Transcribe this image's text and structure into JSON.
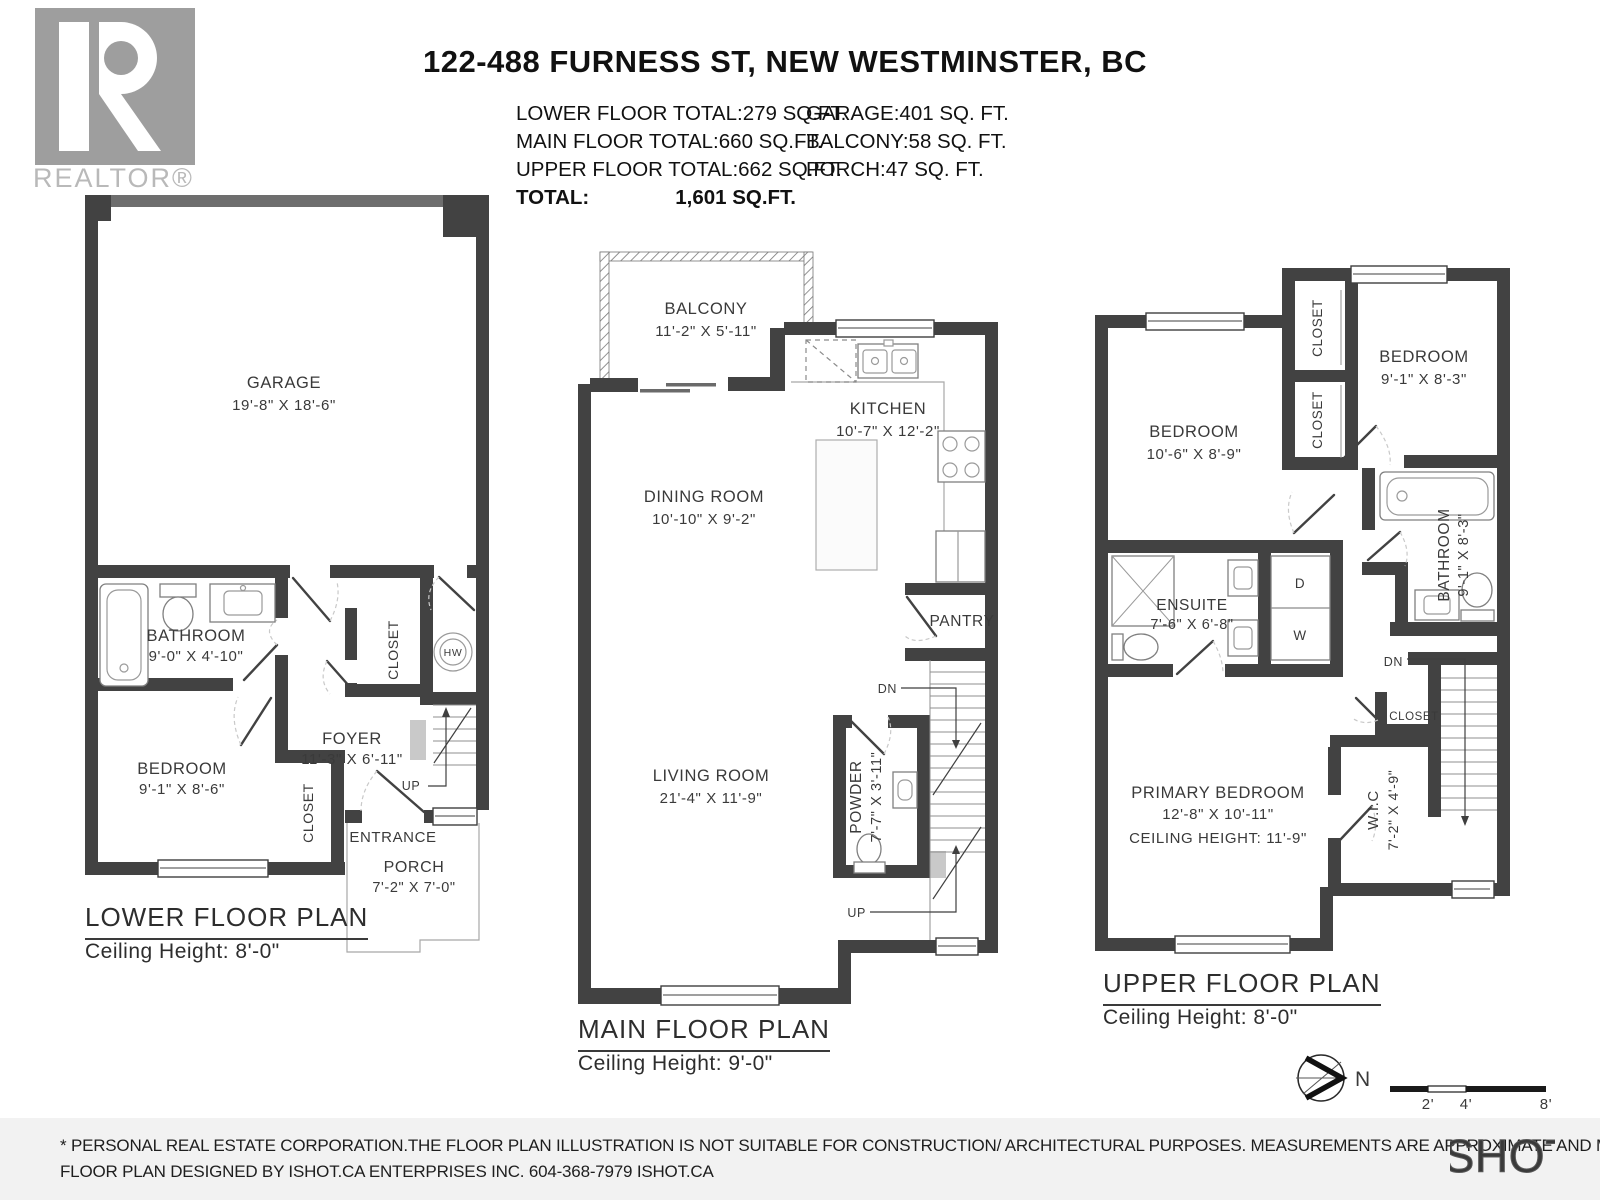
{
  "header": {
    "title": "122-488 FURNESS ST, NEW WESTMINSTER, BC",
    "realtor": {
      "letter": "R",
      "label": "REALTOR®"
    },
    "areas_left": [
      {
        "label": "LOWER FLOOR TOTAL:",
        "value": "279 SQ.FT."
      },
      {
        "label": "MAIN FLOOR TOTAL:",
        "value": "660 SQ.FT."
      },
      {
        "label": "UPPER FLOOR TOTAL:",
        "value": "662 SQ.FT."
      },
      {
        "label": "TOTAL:",
        "value": "1,601 SQ.FT."
      }
    ],
    "areas_right": [
      {
        "label": "GARAGE:",
        "value": "401 SQ. FT."
      },
      {
        "label": "BALCONY:",
        "value": "58 SQ. FT."
      },
      {
        "label": "PORCH:",
        "value": "47 SQ. FT."
      }
    ]
  },
  "lower": {
    "title": "LOWER FLOOR PLAN",
    "ceiling": "Ceiling Height: 8'-0\"",
    "garage": {
      "name": "GARAGE",
      "dims": "19'-8\" X 18'-6\""
    },
    "bathroom": {
      "name": "BATHROOM",
      "dims": "9'-0\" X 4'-10\""
    },
    "bedroom": {
      "name": "BEDROOM",
      "dims": "9'-1\" X 8'-6\""
    },
    "foyer": {
      "name": "FOYER",
      "dims": "11'-3\" X 6'-11\""
    },
    "closet1": "CLOSET",
    "closet2": "CLOSET",
    "hw": "HW",
    "up": "UP",
    "entrance": "ENTRANCE",
    "porch": {
      "name": "PORCH",
      "dims": "7'-2\" X 7'-0\""
    }
  },
  "main": {
    "title": "MAIN FLOOR PLAN",
    "ceiling": "Ceiling Height: 9'-0\"",
    "balcony": {
      "name": "BALCONY",
      "dims": "11'-2\" X 5'-11\""
    },
    "kitchen": {
      "name": "KITCHEN",
      "dims": "10'-7\" X 12'-2\""
    },
    "dining": {
      "name": "DINING ROOM",
      "dims": "10'-10\" X 9'-2\""
    },
    "pantry": "PANTRY",
    "living": {
      "name": "LIVING ROOM",
      "dims": "21'-4\" X 11'-9\""
    },
    "powder": {
      "name": "POWDER",
      "dims": "7'-7\" X 3'-11\""
    },
    "dn": "DN",
    "up": "UP"
  },
  "upper": {
    "title": "UPPER FLOOR PLAN",
    "ceiling": "Ceiling Height: 8'-0\"",
    "bedroom1": {
      "name": "BEDROOM",
      "dims": "10'-6\" X 8'-9\""
    },
    "bedroom2": {
      "name": "BEDROOM",
      "dims": "9'-1\" X 8'-3\""
    },
    "closet1": "CLOSET",
    "closet2": "CLOSET",
    "closet3": "CLOSET",
    "bathroom": {
      "name": "BATHROOM",
      "dims": "9'-1\" X 8'-3\""
    },
    "ensuite": {
      "name": "ENSUITE",
      "dims": "7'-6\" X 6'-8\""
    },
    "dryer": "D",
    "washer": "W",
    "wic": {
      "name": "W.I.C",
      "dims": "7'-2\" X 4'-9\""
    },
    "primary": {
      "name": "PRIMARY BEDROOM",
      "dims": "12'-8\" X 10'-11\"",
      "ceiling": "CEILING HEIGHT: 11'-9\""
    },
    "dn": "DN"
  },
  "footer": {
    "north": "N",
    "scale": [
      "2'",
      "4'",
      "8'"
    ],
    "disclaimer1": "* PERSONAL REAL ESTATE CORPORATION.THE FLOOR PLAN ILLUSTRATION IS NOT SUITABLE FOR CONSTRUCTION/ ARCHITECTURAL PURPOSES. MEASUREMENTS ARE APPROXIMATE AND MAY NOT BE TO SCALE. E&O INSURED.",
    "disclaimer2": "FLOOR PLAN DESIGNED BY ISHOT.CA ENTERPRISES INC. 604-368-7979  ISHOT.CA",
    "brand": "ISHOT"
  }
}
